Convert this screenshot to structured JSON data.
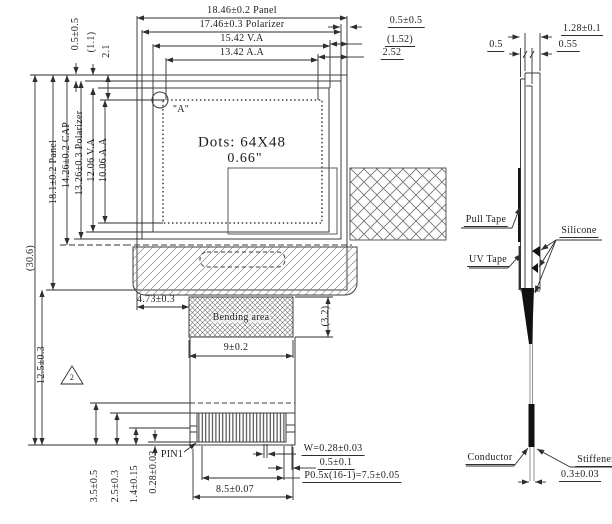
{
  "front": {
    "top": {
      "panel": "18.46±0.2 Panel",
      "polarizer": "17.46±0.3 Polarizer",
      "va": "15.42 V.A",
      "aa": "13.42 A.A",
      "right_gap": "0.5±0.5",
      "right_va": "(1.52)",
      "right_aa": "2.52"
    },
    "topleft": {
      "pol": "0.5±0.5",
      "va": "(1.1)",
      "aa": "2.1"
    },
    "left": {
      "panel": "18.1±0.2 Panel",
      "cap": "14.26±0.2 CAP",
      "polarizer": "13.26±0.3 Polarizer",
      "va": "12.06 V.A",
      "aa": "10.06 A.A",
      "total": "(30.6)",
      "tail": "12.5±0.3",
      "note": "2"
    },
    "display": {
      "dots": "Dots: 64X48",
      "size": "0.66\"",
      "detail": "\"A\""
    },
    "fpc": {
      "offset": "4.73±0.3",
      "bending": "Bending area",
      "bend_h": "(3.2)",
      "bend_w": "9±0.2"
    },
    "conn": {
      "pin1": "PIN1",
      "pad_w": "W=0.28±0.03",
      "margin": "0.5±0.1",
      "pitch": "P0.5x(16-1)=7.5±0.05",
      "width": "8.5±0.07",
      "h1": "3.5±0.5",
      "h2": "2.5±0.3",
      "h3": "1.4±0.15",
      "h4": "0.28±0.03"
    }
  },
  "side": {
    "total": "1.28±0.1",
    "t1": "0.5",
    "t2": "0.55",
    "fpc_t": "0.3±0.03",
    "pull_tape": "Pull Tape",
    "silicone": "Silicone",
    "uv_tape": "UV Tape",
    "conductor": "Conductor",
    "stiffener": "Stiffener"
  }
}
